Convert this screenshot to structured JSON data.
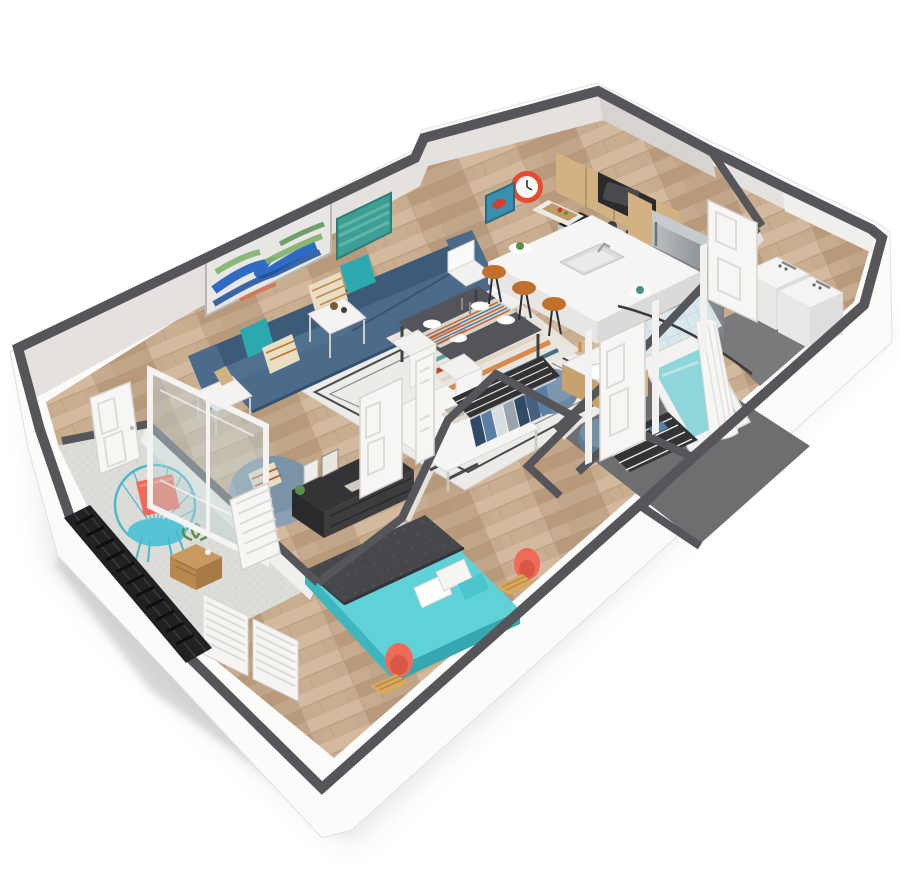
{
  "scene": {
    "type": "isometric-3d-floor-plan",
    "rooms": [
      {
        "name": "living-room",
        "furniture": [
          "sofa",
          "armchair",
          "coffee-table",
          "side-table",
          "side-table",
          "pouf",
          "pouf",
          "area-rug",
          "wall-art-abstract",
          "wall-art-teal"
        ]
      },
      {
        "name": "dining-area",
        "furniture": [
          "dining-table",
          "dining-chair",
          "dining-chair",
          "dining-chair",
          "dining-chair",
          "striped-rug"
        ]
      },
      {
        "name": "kitchen",
        "furniture": [
          "upper-cabinets",
          "microwave",
          "range-oven",
          "refrigerator",
          "island-with-sink",
          "bar-stool",
          "bar-stool",
          "bar-stool",
          "wall-clock",
          "small-art"
        ]
      },
      {
        "name": "bathroom",
        "furniture": [
          "vanity-sink",
          "bathtub",
          "shower-curtain",
          "tile-surround"
        ]
      },
      {
        "name": "laundry-closet",
        "furniture": [
          "washer",
          "dryer"
        ]
      },
      {
        "name": "walk-in-closet",
        "furniture": [
          "hanging-clothes",
          "wire-shelf"
        ]
      },
      {
        "name": "linen-closet",
        "furniture": [
          "wire-shelves"
        ]
      },
      {
        "name": "bedroom",
        "furniture": [
          "bed",
          "media-console",
          "picture-frames",
          "coral-chair",
          "coral-chair",
          "wood-bench",
          "louvered-shutters"
        ]
      },
      {
        "name": "balcony",
        "furniture": [
          "wire-hoop-chair",
          "coral-pillow",
          "cube-side-table",
          "plant",
          "black-railing"
        ]
      }
    ],
    "doors": [
      "entry-door",
      "sliding-glass-door",
      "bedroom-door",
      "bedroom-door-2",
      "bathroom-door",
      "laundry-doors",
      "louvered-door"
    ]
  },
  "colors": {
    "wall_top": "#56565a",
    "exterior_white": "#fbfbfa",
    "wall_face": "#e4e1de",
    "wall_face_bright": "#f1efec",
    "wall_face_shadow": "#d6d3d0",
    "wood_base": "#c7ab8e",
    "wood_dark": "#b29374",
    "wood_light": "#d6bda1",
    "concrete": "#dddcd8",
    "bath_floor": "#6e6e70",
    "railing": "#212124",
    "sofa": "#4c6b8a",
    "sofa_dark": "#3d5a78",
    "pillow_teal": "#2ba9ae",
    "pillow_cream": "#e9ddc4",
    "rug": "#edebe7",
    "rug_line": "#4a4a4e",
    "island_white": "#f6f5f3",
    "cabinet_wood": "#d2b183",
    "cabinet_dark": "#c09a66",
    "steel": "#a9adb1",
    "steel_dark": "#84898e",
    "appliance_black": "#2b2b2d",
    "stool_top": "#c2702e",
    "clock_red": "#e8492f",
    "table_dark": "#53555a",
    "chair_white": "#f2f1ef",
    "bed_teal": "#5ed2d6",
    "bed_teal_dark": "#3cb6bf",
    "blanket_gray": "#47474b",
    "coral": "#ef6a58",
    "console_dark": "#343336",
    "plant_green": "#5a8f4c",
    "water_teal": "#8fd6da",
    "tile_blue": "#d9e8ed",
    "curtain_white": "#f6f6f4",
    "door_white": "#f7f6f4",
    "glass": "#bfd2d8",
    "closet_dark": "#333335",
    "clothes_navy": "#2f4a66",
    "clothes_blue": "#5a7fa6",
    "clothes_gray": "#9aa4ad",
    "art_teal": "#3e9f94",
    "art_blue": "#2e6bc4",
    "shadow": "#c9c7c4"
  }
}
